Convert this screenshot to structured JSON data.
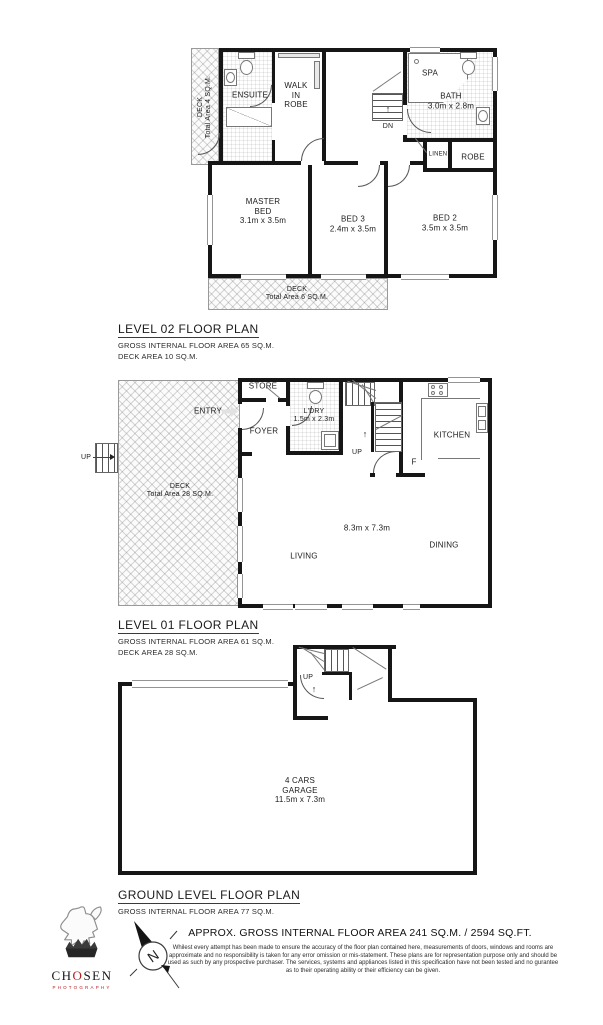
{
  "level2": {
    "title": "LEVEL 02 FLOOR PLAN",
    "area_line1": "GROSS INTERNAL FLOOR AREA 65 SQ.M.",
    "area_line2": "DECK AREA 10 SQ.M.",
    "labels": {
      "deck_side": "DECK\nTotal Area 4 SQ.M.",
      "ensuite": "ENSUITE",
      "walk_in_robe": "WALK\nIN\nROBE",
      "dn": "DN",
      "spa": "SPA",
      "bath": "BATH\n3.0m x 2.8m",
      "linen": "LINEN",
      "robe": "ROBE",
      "master_bed": "MASTER\nBED\n3.1m x 3.5m",
      "bed3": "BED 3\n2.4m x 3.5m",
      "bed2": "BED 2\n3.5m x 3.5m",
      "deck_bottom": "DECK\nTotal Area 6 SQ.M."
    }
  },
  "level1": {
    "title": "LEVEL 01 FLOOR PLAN",
    "area_line1": "GROSS INTERNAL FLOOR AREA 61 SQ.M.",
    "area_line2": "DECK AREA 28 SQ.M.",
    "labels": {
      "store": "STORE",
      "entry": "ENTRY",
      "foyer": "FOYER",
      "ldry": "L'DRY\n1.5m x 2.3m",
      "up": "UP",
      "up_side": "UP",
      "kitchen": "KITCHEN",
      "fridge": "F",
      "dimensions": "8.3m x 7.3m",
      "living": "LIVING",
      "dining": "DINING",
      "deck": "DECK\nTotal Area 28 SQ.M."
    }
  },
  "ground": {
    "title": "GROUND LEVEL FLOOR PLAN",
    "area_line1": "GROSS INTERNAL FLOOR AREA 77 SQ.M.",
    "labels": {
      "up": "UP",
      "garage": "4 CARS\nGARAGE\n11.5m x 7.3m"
    }
  },
  "footer": {
    "logo_part1": "CH",
    "logo_part2": "O",
    "logo_part3": "SEN",
    "logo_tagline": "PHOTOGRAPHY",
    "compass_n": "N",
    "approx": "APPROX. GROSS INTERNAL FLOOR AREA 241 SQ.M. / 2594 SQ.FT.",
    "disclaimer_lines": [
      "Whilest every attempt has been made to ensure the accuracy of the floor plan contained here, measurements of doors, windows and rooms are",
      "approximate and no responsibility is taken for any error omission or mis-statement. These plans are for representation purpose only and should be",
      "used as such by any prospective purchaser. The services, systems and appliances listed in this specification have not been tested and no gurantee",
      "as to their operating ability or their efficiency can be given."
    ]
  },
  "colors": {
    "wall": "#161616",
    "window_gray": "#949494",
    "logo_accent": "#b32020"
  }
}
